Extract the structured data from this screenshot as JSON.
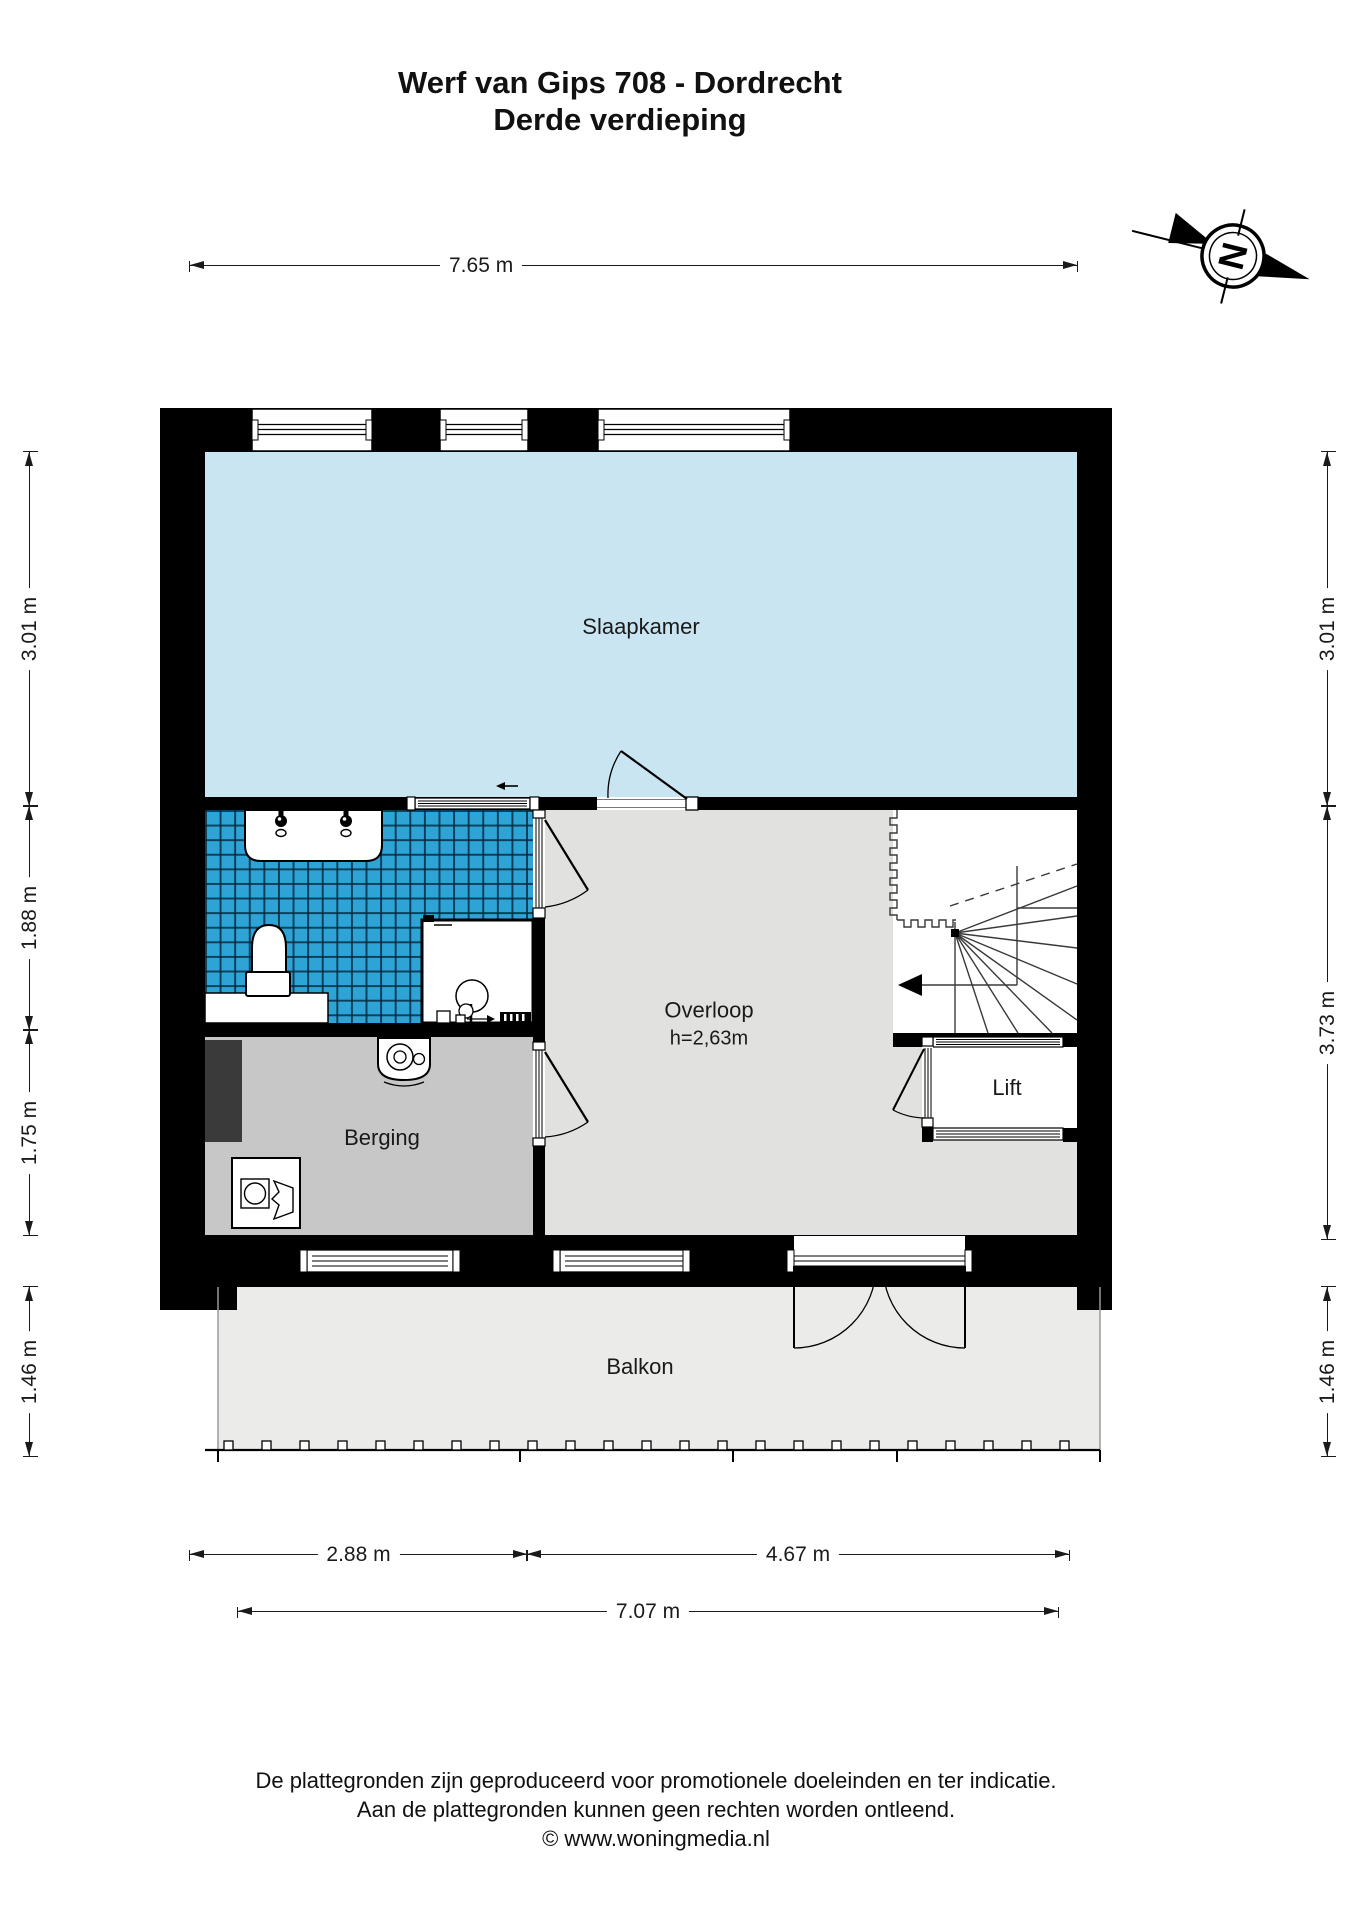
{
  "title": {
    "line1": "Werf van Gips 708 - Dordrecht",
    "line2": "Derde verdieping"
  },
  "compass": {
    "label": "N"
  },
  "rooms": {
    "slaapkamer": {
      "label": "Slaapkamer"
    },
    "overloop": {
      "label": "Overloop",
      "height_note": "h=2,63m"
    },
    "berging": {
      "label": "Berging"
    },
    "lift": {
      "label": "Lift"
    },
    "balkon": {
      "label": "Balkon"
    }
  },
  "dimensions": {
    "top": {
      "label": "7.65 m"
    },
    "left": [
      {
        "label": "3.01 m"
      },
      {
        "label": "1.88 m"
      },
      {
        "label": "1.75 m"
      },
      {
        "label": "1.46 m"
      }
    ],
    "right": [
      {
        "label": "3.01 m"
      },
      {
        "label": "3.73 m"
      },
      {
        "label": "1.46 m"
      }
    ],
    "bottom_row1": [
      {
        "label": "2.88 m"
      },
      {
        "label": "4.67 m"
      }
    ],
    "bottom_row2": {
      "label": "7.07 m"
    }
  },
  "footer": {
    "line1": "De plattegronden zijn geproduceerd voor promotionele doeleinden en ter indicatie.",
    "line2": "Aan de plattegronden kunnen geen rechten worden ontleend.",
    "line3": "© www.woningmedia.nl"
  },
  "colors": {
    "bedroom": "#c9e5f1",
    "bathroom_tile": "#2da3d6",
    "berging": "#c7c7c7",
    "overloop": "#e1e1df",
    "balkon": "#ebebe9",
    "wall": "#000000",
    "shaft": "#3a3a3a"
  }
}
